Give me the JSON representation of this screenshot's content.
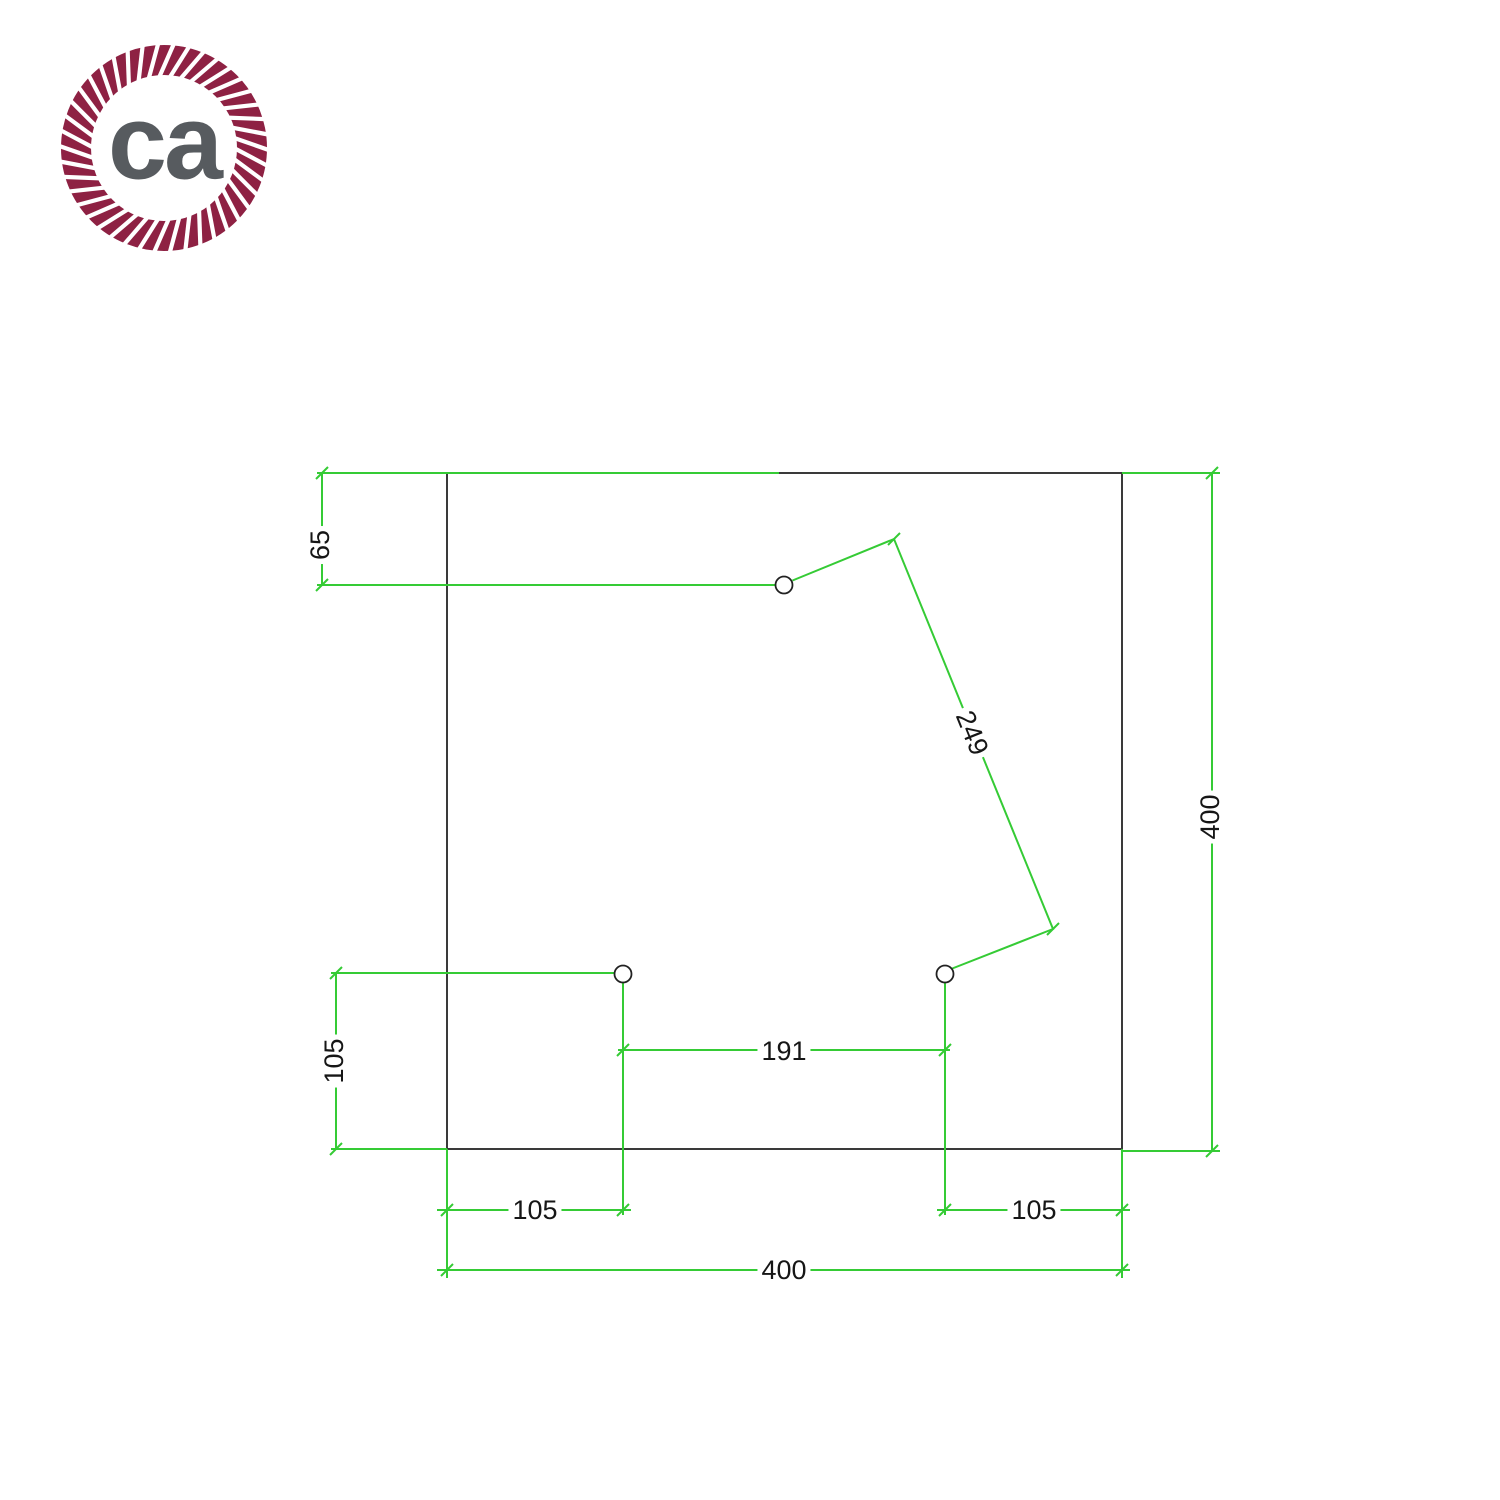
{
  "logo": {
    "text": "ca",
    "rope_color": "#8e2143",
    "text_color": "#575b5f"
  },
  "drawing": {
    "line_color": "#35cb35",
    "outline_color": "#3a3a3a",
    "dim_text_color": "#161616",
    "dimensions": {
      "square_width": "400",
      "square_height": "400",
      "top_hole_from_top": "65",
      "left_hole_from_bottom": "105",
      "left_hole_from_left": "105",
      "right_hole_from_right": "105",
      "holes_spacing": "191",
      "diagonal_holes_spacing": "249"
    }
  }
}
